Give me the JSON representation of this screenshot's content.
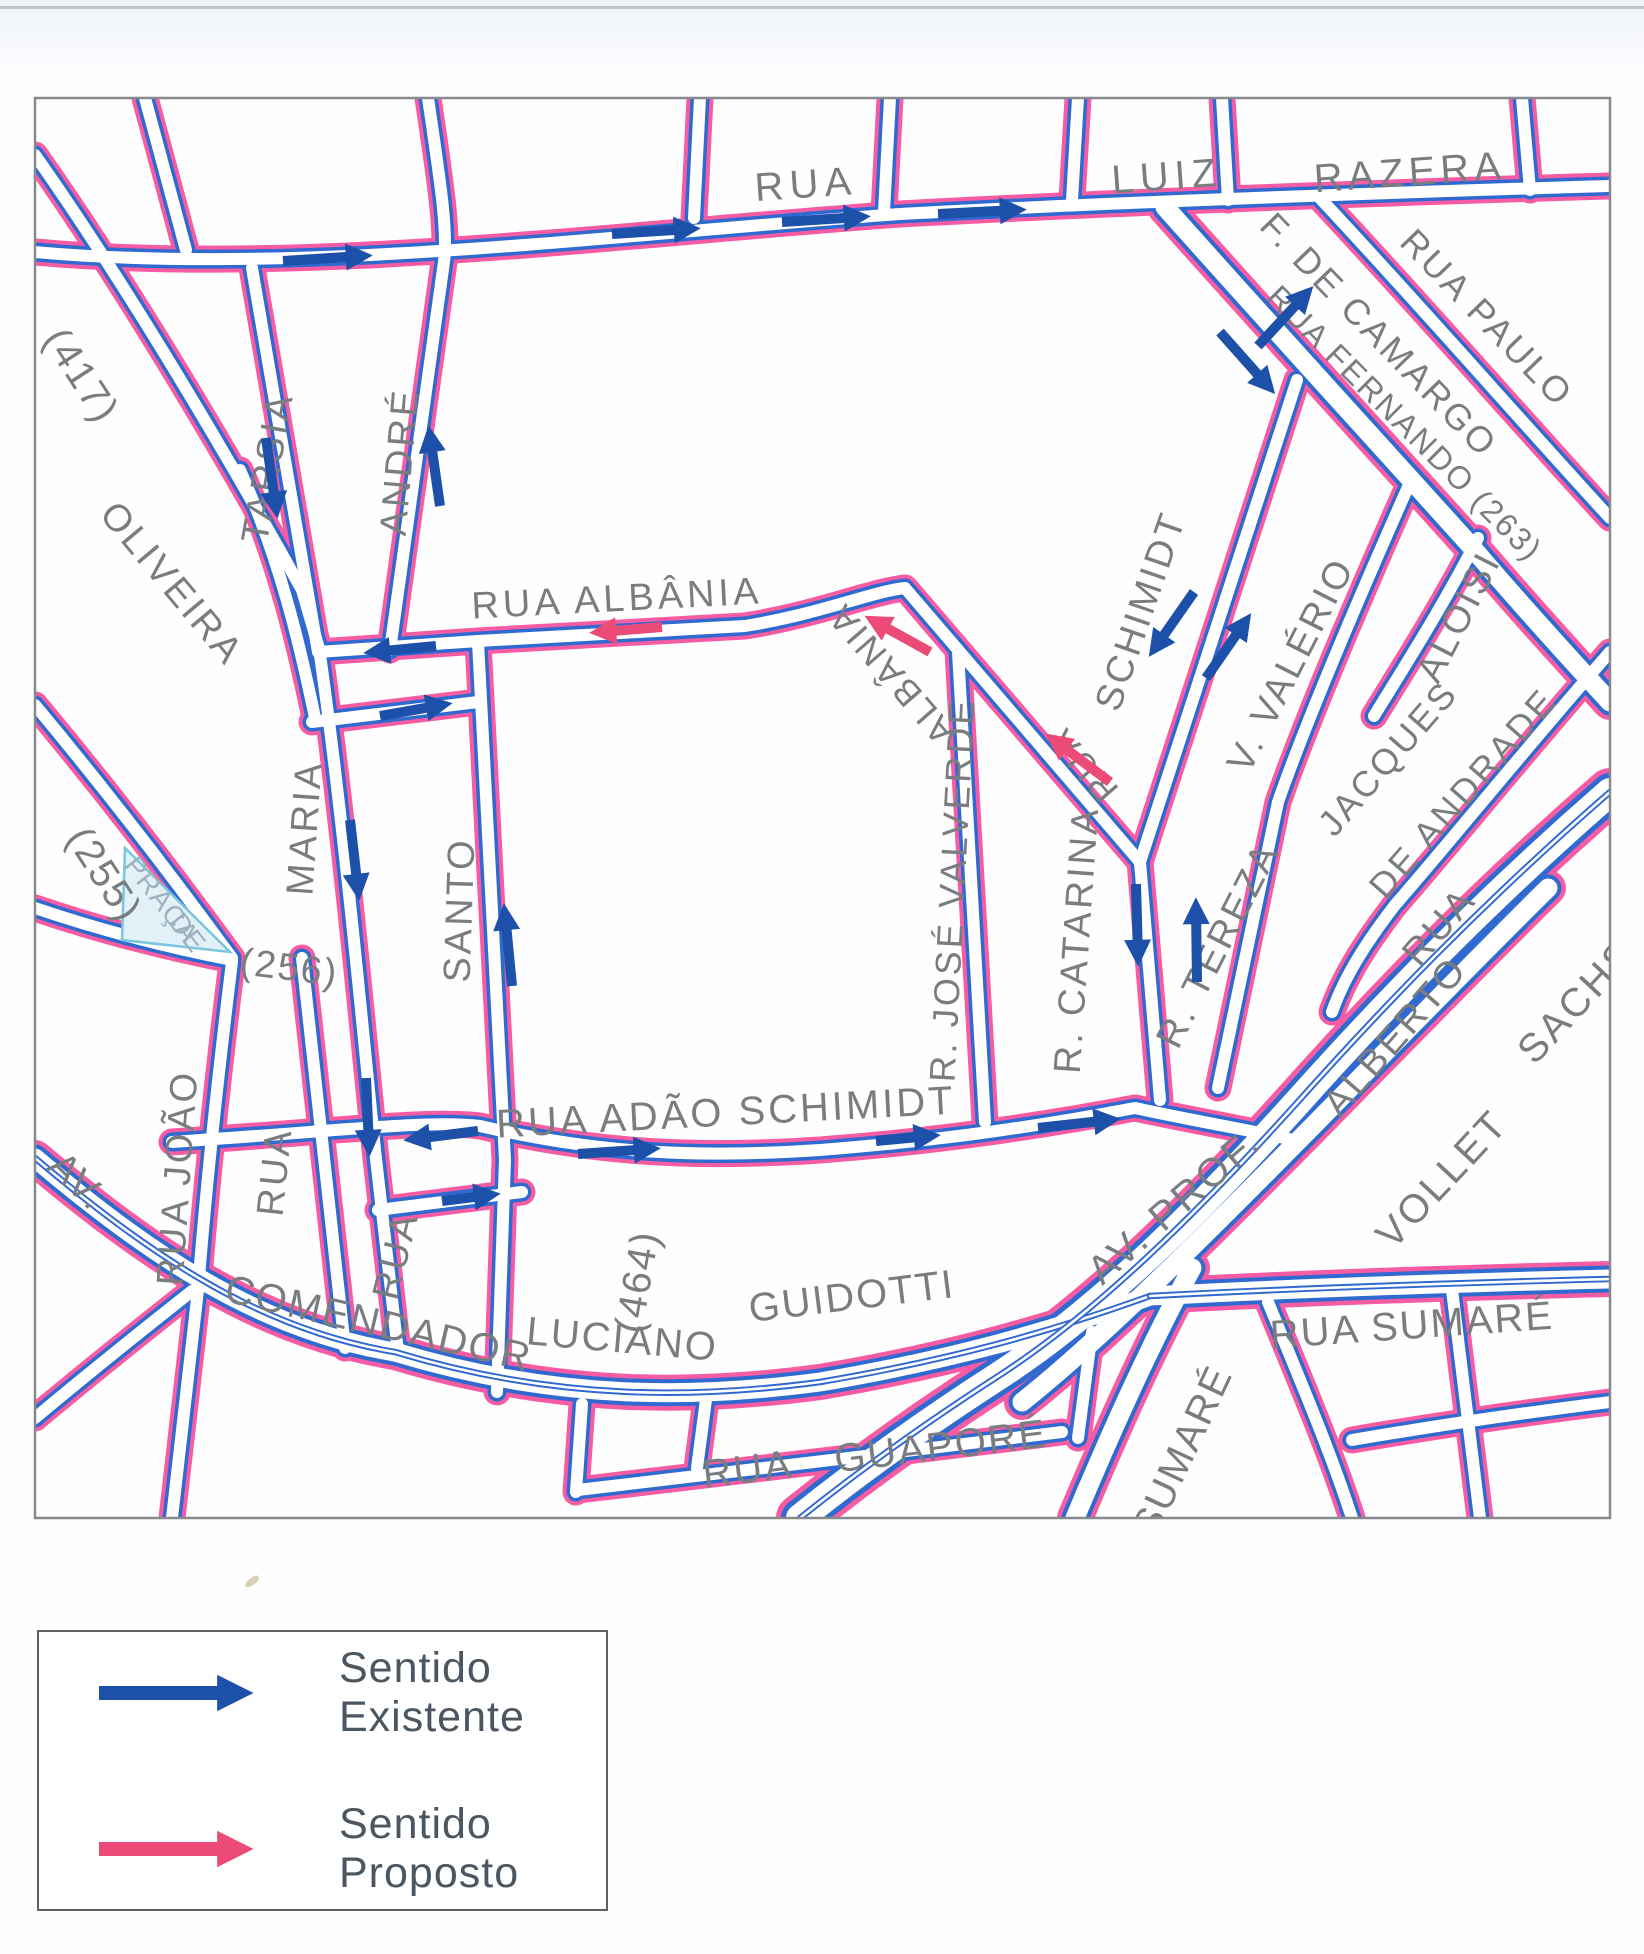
{
  "colors": {
    "street_blue": "#3069d0",
    "street_pink": "#f55ca4",
    "arrow_blue": "#1d50a8",
    "arrow_pink": "#ec4a77",
    "label_gray": "#7a7d80",
    "praca_text": "#9fb3bf",
    "praca_fill": "#e2f1f8",
    "praca_edge": "#79c6dd",
    "border": "#87898c",
    "legend_text": "#4b5660"
  },
  "legend": {
    "existing_label": "Sentido Existente",
    "proposed_label": "Sentido Proposto"
  },
  "map": {
    "border": {
      "x": 35,
      "y": 98,
      "w": 1575,
      "h": 1420
    },
    "praca": {
      "points": "125,848 230,952 122,940"
    },
    "streets": [
      {
        "n": "rua-top",
        "d": "M 35 252 C 300 276, 620 234, 900 214 C 1100 203, 1400 192, 1610 186"
      },
      {
        "n": "v-145",
        "d": "M 145 98 L 186 250"
      },
      {
        "n": "v-700",
        "d": "M 700 98 L 694 218"
      },
      {
        "n": "v-884",
        "d": "M 890 98 L 884 212"
      },
      {
        "n": "v-1078",
        "d": "M 1078 98 L 1072 200"
      },
      {
        "n": "v-luiz",
        "d": "M 1222 98 L 1228 200"
      },
      {
        "n": "v-razera",
        "d": "M 1522 98 L 1530 190"
      },
      {
        "n": "rua-417",
        "d": "M 35 155 C 130 290, 230 460, 302 590 L 320 652"
      },
      {
        "n": "tarsia",
        "d": "M 252 268 L 318 652"
      },
      {
        "n": "andre",
        "d": "M 428 98 C 440 180, 448 230, 444 262 L 390 650"
      },
      {
        "n": "oliveira",
        "d": "M 240 470 C 280 560, 300 645, 315 718"
      },
      {
        "n": "rua-255",
        "d": "M 35 705 C 110 795, 175 880, 232 958"
      },
      {
        "n": "praca-sul",
        "d": "M 35 908 C 100 930, 170 948, 232 960"
      },
      {
        "n": "rua-albania",
        "d": "M 318 652 L 478 641 L 745 626 C 820 614, 870 592, 905 588 L 1140 862"
      },
      {
        "n": "maria",
        "d": "M 320 655 C 335 760, 350 900, 360 1000 C 368 1080, 372 1120, 375 1150 L 398 1352"
      },
      {
        "n": "rua-y710",
        "d": "M 312 722 L 478 702"
      },
      {
        "n": "santo",
        "d": "M 478 642 L 505 1160 L 497 1392"
      },
      {
        "n": "rua-joao",
        "d": "M 232 962 C 215 1100, 205 1200, 198 1290 L 172 1518"
      },
      {
        "n": "v-310",
        "d": "M 302 958 L 345 1348"
      },
      {
        "n": "jose-valverde",
        "d": "M 958 652 L 985 1122"
      },
      {
        "n": "catarina",
        "d": "M 1140 862 L 1160 1100"
      },
      {
        "n": "valerio-tereza",
        "d": "M 1412 478 C 1340 640, 1298 745, 1278 802 L 1218 1088"
      },
      {
        "n": "schimidt-diag",
        "d": "M 1297 380 L 1140 862"
      },
      {
        "n": "fernando",
        "w": "w",
        "d": "M 1165 207 C 1270 325, 1380 445, 1470 545 C 1515 598, 1562 650, 1610 702"
      },
      {
        "n": "paulo",
        "d": "M 1318 196 C 1420 305, 1520 420, 1610 518"
      },
      {
        "n": "aloisi",
        "d": "M 1478 538 C 1442 608, 1406 664, 1374 716"
      },
      {
        "n": "jacques-andrade",
        "d": "M 1610 652 C 1520 755, 1445 848, 1395 905 C 1368 940, 1345 975, 1332 1012"
      },
      {
        "n": "adao-schimidt",
        "d": "M 172 1142 C 350 1130, 430 1120, 480 1126 C 600 1154, 700 1158, 820 1150 C 950 1140, 1050 1124, 1135 1108 C 1200 1122, 1260 1132, 1298 1141"
      },
      {
        "n": "rua-y1200",
        "d": "M 378 1210 L 522 1192"
      },
      {
        "n": "comendador-guidotti",
        "w": "w",
        "m": true,
        "d": "M 35 1158 C 150 1255, 260 1330, 395 1352 C 560 1402, 700 1398, 820 1382 C 950 1360, 1050 1332, 1150 1296"
      },
      {
        "n": "sumare-leste",
        "w": "w",
        "m": true,
        "d": "M 1150 1296 C 1300 1288, 1450 1283, 1610 1279"
      },
      {
        "n": "av-prof",
        "w": "w",
        "d": "M 1022 1402 C 1100 1340, 1200 1240, 1298 1141 C 1380 1058, 1460 975, 1548 888"
      },
      {
        "n": "vollet-sachs",
        "w": "x",
        "m": true,
        "d": "M 1610 792 C 1480 905, 1380 1010, 1295 1105 C 1200 1210, 1100 1310, 1000 1375 C 930 1420, 860 1470, 800 1518"
      },
      {
        "n": "sumare-diag",
        "w": "w",
        "d": "M 1192 1268 C 1150 1345, 1112 1430, 1075 1518"
      },
      {
        "n": "x-bl",
        "d": "M 35 1418 C 90 1372, 140 1332, 192 1291"
      },
      {
        "n": "x-580",
        "d": "M 582 1404 L 576 1492"
      },
      {
        "n": "guapore",
        "d": "M 578 1490 C 750 1470, 900 1452, 1062 1432"
      },
      {
        "n": "v-705",
        "d": "M 707 1392 L 697 1468"
      },
      {
        "n": "v-1092",
        "d": "M 1092 1332 L 1078 1438"
      },
      {
        "n": "br-1",
        "d": "M 1268 1302 C 1300 1380, 1330 1450, 1352 1518"
      },
      {
        "n": "br-2",
        "d": "M 1452 1290 L 1480 1518"
      },
      {
        "n": "br-3",
        "d": "M 1352 1440 C 1440 1425, 1530 1412, 1610 1402"
      }
    ],
    "labels": [
      {
        "t": "RUA",
        "x": 806,
        "y": 187,
        "r": -4,
        "s": 40,
        "ls": 6
      },
      {
        "t": "LUIZ",
        "x": 1167,
        "y": 179,
        "r": -4,
        "s": 40,
        "ls": 6
      },
      {
        "t": "RAZERA",
        "x": 1410,
        "y": 175,
        "r": -4,
        "s": 40,
        "ls": 5
      },
      {
        "t": "(417)",
        "x": 79,
        "y": 377,
        "r": 57,
        "s": 40,
        "ls": 2
      },
      {
        "t": "TARSIA",
        "x": 270,
        "y": 468,
        "r": -80,
        "s": 38,
        "ls": 3
      },
      {
        "t": "ANDRÉ",
        "x": 402,
        "y": 462,
        "r": -85,
        "s": 38,
        "ls": 3
      },
      {
        "t": "OLIVEIRA",
        "x": 170,
        "y": 585,
        "r": 50,
        "s": 38,
        "ls": 3
      },
      {
        "t": "RUA  ALBÂNIA",
        "x": 617,
        "y": 601,
        "r": -3,
        "s": 38,
        "ls": 4
      },
      {
        "t": "ALBÂNIA",
        "x": 893,
        "y": 672,
        "r": -131,
        "s": 36,
        "ls": 3
      },
      {
        "t": "RUA",
        "x": 1085,
        "y": 763,
        "r": -131,
        "s": 36,
        "ls": 3
      },
      {
        "t": "SCHIMIDT",
        "x": 1143,
        "y": 612,
        "r": -71,
        "s": 38,
        "ls": 3
      },
      {
        "t": "V.  VALÉRIO",
        "x": 1293,
        "y": 666,
        "r": -63,
        "s": 38,
        "ls": 3
      },
      {
        "t": "ALOISI",
        "x": 1461,
        "y": 618,
        "r": -63,
        "s": 38,
        "ls": 3
      },
      {
        "t": "JACQUES",
        "x": 1390,
        "y": 760,
        "r": -49,
        "s": 36,
        "ls": 3
      },
      {
        "t": "DE  ANDRADE",
        "x": 1465,
        "y": 795,
        "r": -49,
        "s": 36,
        "ls": 3
      },
      {
        "t": "F. DE CAMARGO",
        "x": 1377,
        "y": 337,
        "r": 46,
        "s": 36,
        "ls": 3
      },
      {
        "t": "RUA  PAULO",
        "x": 1485,
        "y": 320,
        "r": 46,
        "s": 36,
        "ls": 3
      },
      {
        "t": "RUA  FERNANDO  (263)",
        "x": 1403,
        "y": 425,
        "r": 45,
        "s": 32,
        "ls": 2
      },
      {
        "t": "(255)",
        "x": 102,
        "y": 876,
        "r": 57,
        "s": 40,
        "ls": 2
      },
      {
        "t": "MARIA",
        "x": 307,
        "y": 828,
        "r": -86,
        "s": 38,
        "ls": 3
      },
      {
        "t": "(256)",
        "x": 289,
        "y": 970,
        "r": 7,
        "s": 38,
        "ls": 2
      },
      {
        "t": "SANTO",
        "x": 462,
        "y": 910,
        "r": -88,
        "s": 38,
        "ls": 3
      },
      {
        "t": "R.  JOSÉ  VALVERDE",
        "x": 955,
        "y": 890,
        "r": -87,
        "s": 36,
        "ls": 3
      },
      {
        "t": "R.  CATARINA",
        "x": 1079,
        "y": 940,
        "r": -86,
        "s": 38,
        "ls": 3
      },
      {
        "t": "R.  TEREZA",
        "x": 1220,
        "y": 946,
        "r": -63,
        "s": 38,
        "ls": 3
      },
      {
        "t": "RUA",
        "x": 1441,
        "y": 928,
        "r": -49,
        "s": 38,
        "ls": 3
      },
      {
        "t": "ALBERTO",
        "x": 1397,
        "y": 1038,
        "r": -49,
        "s": 38,
        "ls": 3
      },
      {
        "t": "VOLLET",
        "x": 1444,
        "y": 1181,
        "r": -47,
        "s": 40,
        "ls": 3
      },
      {
        "t": "SACHS",
        "x": 1579,
        "y": 1003,
        "r": -47,
        "s": 40,
        "ls": 3
      },
      {
        "t": "AV.",
        "x": 76,
        "y": 1183,
        "r": 44,
        "s": 40,
        "ls": 2
      },
      {
        "t": "RUA  JOÃO",
        "x": 180,
        "y": 1178,
        "r": -86,
        "s": 38,
        "ls": 3
      },
      {
        "t": "RUA",
        "x": 277,
        "y": 1172,
        "r": -84,
        "s": 38,
        "ls": 3
      },
      {
        "t": "RUA",
        "x": 398,
        "y": 1256,
        "r": -76,
        "s": 38,
        "ls": 3
      },
      {
        "t": "RUA  ADÃO  SCHIMIDT",
        "x": 726,
        "y": 1115,
        "r": -3,
        "s": 40,
        "ls": 3
      },
      {
        "t": "COMENDADOR",
        "x": 378,
        "y": 1326,
        "r": 13,
        "s": 40,
        "ls": 2
      },
      {
        "t": "LUCIANO",
        "x": 622,
        "y": 1342,
        "r": 5,
        "s": 40,
        "ls": 2
      },
      {
        "t": "(464)",
        "x": 640,
        "y": 1282,
        "r": -80,
        "s": 40,
        "ls": 2
      },
      {
        "t": "GUIDOTTI",
        "x": 852,
        "y": 1299,
        "r": -7,
        "s": 40,
        "ls": 2
      },
      {
        "t": "AV.  PROF.",
        "x": 1176,
        "y": 1208,
        "r": -41,
        "s": 40,
        "ls": 3
      },
      {
        "t": "RUA SUMARÉ",
        "x": 1412,
        "y": 1328,
        "r": -4,
        "s": 40,
        "ls": 2
      },
      {
        "t": "SUMARÉ",
        "x": 1185,
        "y": 1452,
        "r": -65,
        "s": 40,
        "ls": 2
      },
      {
        "t": "RUA",
        "x": 748,
        "y": 1472,
        "r": -7,
        "s": 40,
        "ls": 2
      },
      {
        "t": "GUAPORÉ",
        "x": 941,
        "y": 1449,
        "r": -7,
        "s": 40,
        "ls": 2
      },
      {
        "t": "PRAÇA",
        "x": 160,
        "y": 901,
        "r": 52,
        "s": 28,
        "ls": 1,
        "c": "praca_text"
      },
      {
        "t": "DE",
        "x": 186,
        "y": 934,
        "r": 52,
        "s": 28,
        "ls": 1,
        "c": "praca_text"
      }
    ],
    "arrows": [
      {
        "x1": 283,
        "y1": 261,
        "x2": 362,
        "y2": 256,
        "c": "existing"
      },
      {
        "x1": 612,
        "y1": 234,
        "x2": 690,
        "y2": 229,
        "c": "existing"
      },
      {
        "x1": 782,
        "y1": 222,
        "x2": 860,
        "y2": 217,
        "c": "existing"
      },
      {
        "x1": 938,
        "y1": 214,
        "x2": 1016,
        "y2": 210,
        "c": "existing"
      },
      {
        "x1": 266,
        "y1": 438,
        "x2": 276,
        "y2": 508,
        "c": "existing"
      },
      {
        "x1": 440,
        "y1": 506,
        "x2": 430,
        "y2": 436,
        "c": "existing"
      },
      {
        "x1": 1258,
        "y1": 346,
        "x2": 1306,
        "y2": 294,
        "c": "existing"
      },
      {
        "x1": 1220,
        "y1": 332,
        "x2": 1268,
        "y2": 386,
        "c": "existing"
      },
      {
        "x1": 436,
        "y1": 646,
        "x2": 374,
        "y2": 652,
        "c": "existing"
      },
      {
        "x1": 380,
        "y1": 716,
        "x2": 442,
        "y2": 705,
        "c": "existing"
      },
      {
        "x1": 350,
        "y1": 820,
        "x2": 358,
        "y2": 890,
        "c": "existing"
      },
      {
        "x1": 512,
        "y1": 986,
        "x2": 505,
        "y2": 914,
        "c": "existing"
      },
      {
        "x1": 1194,
        "y1": 592,
        "x2": 1155,
        "y2": 648,
        "c": "existing"
      },
      {
        "x1": 1206,
        "y1": 678,
        "x2": 1245,
        "y2": 622,
        "c": "existing"
      },
      {
        "x1": 1136,
        "y1": 884,
        "x2": 1138,
        "y2": 956,
        "c": "existing"
      },
      {
        "x1": 1197,
        "y1": 982,
        "x2": 1196,
        "y2": 908,
        "c": "existing"
      },
      {
        "x1": 366,
        "y1": 1078,
        "x2": 369,
        "y2": 1146,
        "c": "existing"
      },
      {
        "x1": 478,
        "y1": 1131,
        "x2": 414,
        "y2": 1139,
        "c": "existing"
      },
      {
        "x1": 578,
        "y1": 1154,
        "x2": 650,
        "y2": 1149,
        "c": "existing"
      },
      {
        "x1": 876,
        "y1": 1141,
        "x2": 930,
        "y2": 1136,
        "c": "existing"
      },
      {
        "x1": 1038,
        "y1": 1128,
        "x2": 1110,
        "y2": 1120,
        "c": "existing"
      },
      {
        "x1": 442,
        "y1": 1201,
        "x2": 490,
        "y2": 1195,
        "c": "existing"
      },
      {
        "x1": 662,
        "y1": 627,
        "x2": 600,
        "y2": 632,
        "c": "proposed"
      },
      {
        "x1": 930,
        "y1": 652,
        "x2": 874,
        "y2": 621,
        "c": "proposed"
      },
      {
        "x1": 1110,
        "y1": 782,
        "x2": 1054,
        "y2": 740,
        "c": "proposed"
      }
    ]
  }
}
